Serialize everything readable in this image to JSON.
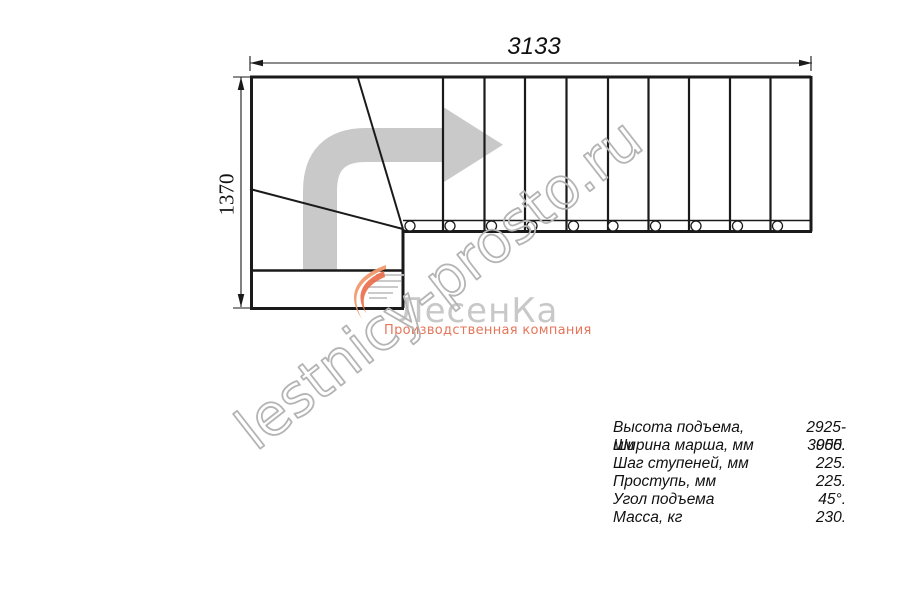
{
  "drawing": {
    "width_dimension_mm": "3133",
    "height_dimension_mm": "1370"
  },
  "logo": {
    "brand": "ЛесенКа",
    "tagline": "Производственная компания"
  },
  "watermark": {
    "text": "lestnicy-prosto.ru"
  },
  "specs": {
    "rows": [
      {
        "label": "Высота подъема, мм",
        "value": "2925-3055."
      },
      {
        "label": "Ширина марша, мм",
        "value": "900."
      },
      {
        "label": "Шаг ступеней, мм",
        "value": "225."
      },
      {
        "label": "Проступь, мм",
        "value": "225."
      },
      {
        "label": "Угол подъема",
        "value": "45°."
      },
      {
        "label": "Масса, кг",
        "value": "230."
      }
    ]
  },
  "colors": {
    "line": "#1a1a1a",
    "arrow_gray": "#c9c9c9",
    "brand_gray": "#c8c8c8",
    "brand_orange": "#e5765a",
    "watermark_gray": "#b4b4b4"
  }
}
